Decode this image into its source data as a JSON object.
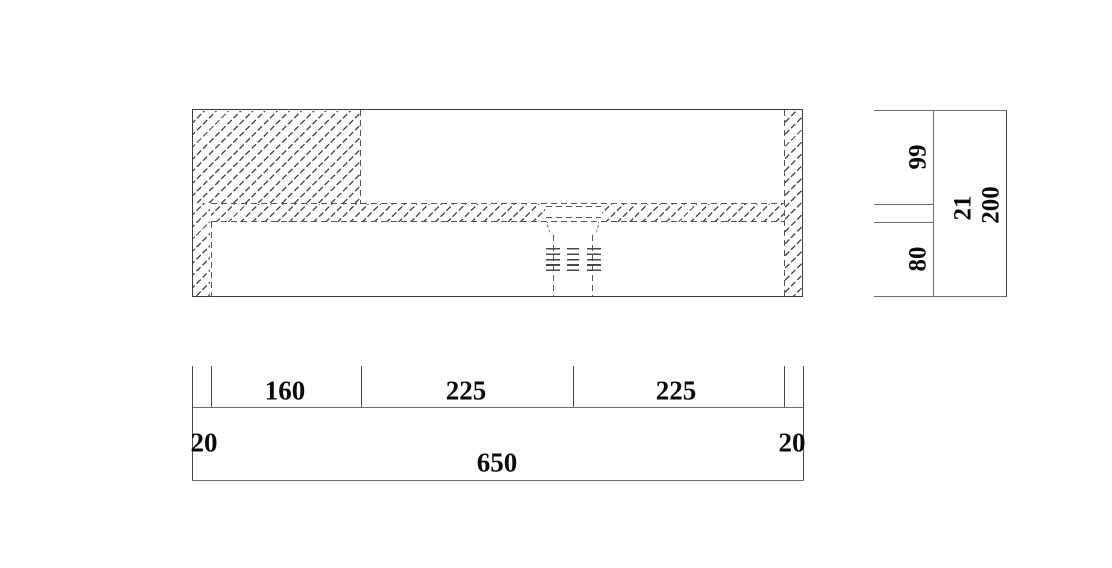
{
  "drawing_type": "section-elevation of basin/counter unit with drain, two views with dimension chains",
  "front_view": {
    "dim_chain_horizontal": {
      "left_wall": "20",
      "block_segment": "160",
      "mid_segment": "225",
      "right_segment": "225",
      "right_wall": "20",
      "total": "650"
    }
  },
  "side_view": {
    "dim_chain_vertical": {
      "top_section": "99",
      "slab_thickness": "21",
      "bottom_section": "80",
      "total": "200"
    }
  },
  "colors": {
    "outline": "#3d3d3d",
    "hidden_line": "#555555",
    "dimension_line": "#6e6e6e",
    "hatch": "#4d4d4d",
    "text": "#0a0a0a",
    "background": "#ffffff"
  }
}
